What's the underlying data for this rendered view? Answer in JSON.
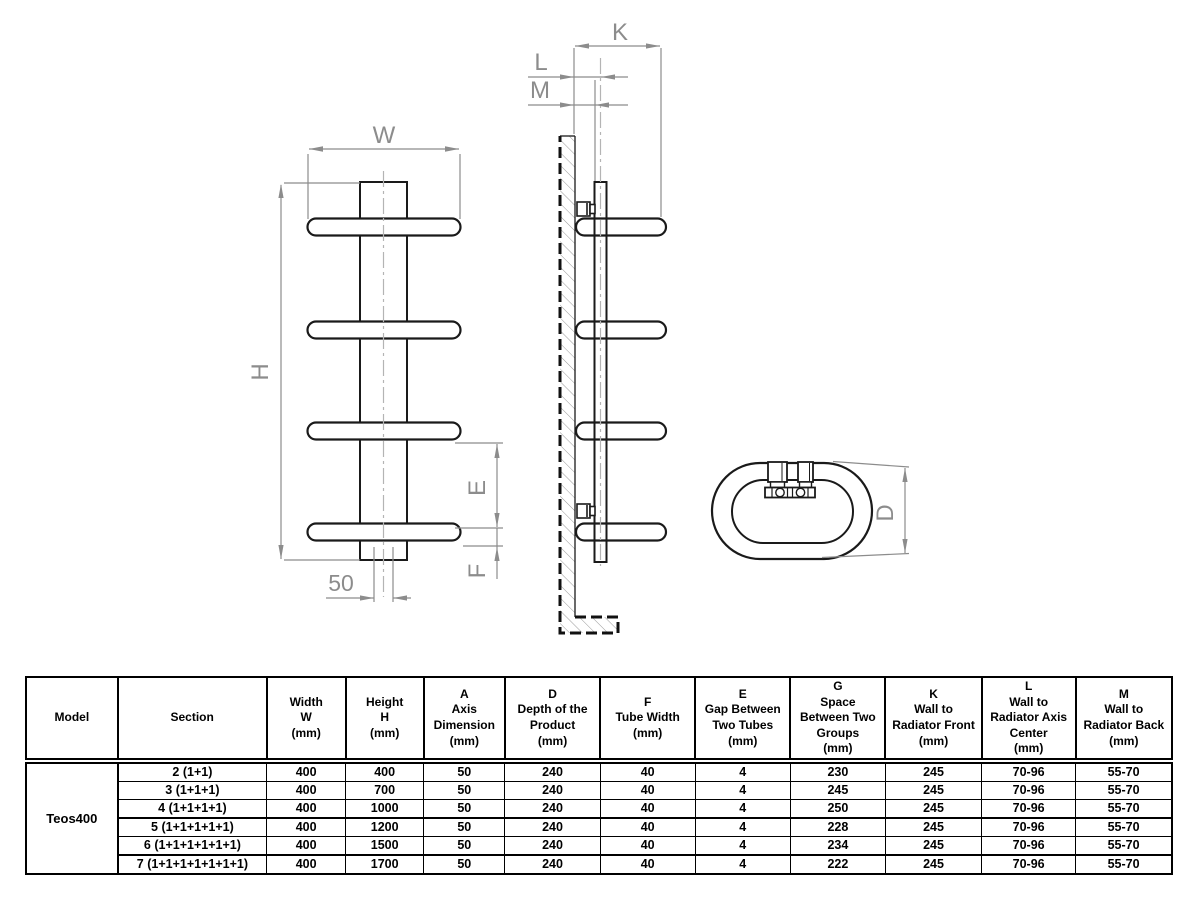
{
  "drawing": {
    "labels": {
      "w": "W",
      "h": "H",
      "e": "E",
      "f": "F",
      "fifty": "50",
      "k": "K",
      "l": "L",
      "m": "M",
      "d": "D"
    },
    "colors": {
      "product_line": "#1a1a1a",
      "dimension": "#8c8c8c",
      "centerline": "#b4b4b4",
      "hatch": "#9a9a9a"
    }
  },
  "table": {
    "headers": [
      "Model",
      "Section",
      "Width\nW\n(mm)",
      "Height\nH\n(mm)",
      "A\nAxis\nDimension\n(mm)",
      "D\nDepth of the\nProduct\n(mm)",
      "F\nTube Width\n(mm)",
      "E\nGap Between\nTwo Tubes\n(mm)",
      "G\nSpace\nBetween Two\nGroups\n(mm)",
      "K\nWall to\nRadiator Front\n(mm)",
      "L\nWall to\nRadiator  Axis\nCenter\n(mm)",
      "M\nWall to\nRadiator  Back\n(mm)"
    ],
    "model": "Teos400",
    "rows": [
      [
        "2 (1+1)",
        "400",
        "400",
        "50",
        "240",
        "40",
        "4",
        "230",
        "245",
        "70-96",
        "55-70"
      ],
      [
        "3 (1+1+1)",
        "400",
        "700",
        "50",
        "240",
        "40",
        "4",
        "245",
        "245",
        "70-96",
        "55-70"
      ],
      [
        "4 (1+1+1+1)",
        "400",
        "1000",
        "50",
        "240",
        "40",
        "4",
        "250",
        "245",
        "70-96",
        "55-70"
      ],
      [
        "5 (1+1+1+1+1)",
        "400",
        "1200",
        "50",
        "240",
        "40",
        "4",
        "228",
        "245",
        "70-96",
        "55-70"
      ],
      [
        "6 (1+1+1+1+1+1)",
        "400",
        "1500",
        "50",
        "240",
        "40",
        "4",
        "234",
        "245",
        "70-96",
        "55-70"
      ],
      [
        "7 (1+1+1+1+1+1+1)",
        "400",
        "1700",
        "50",
        "240",
        "40",
        "4",
        "222",
        "245",
        "70-96",
        "55-70"
      ]
    ]
  }
}
